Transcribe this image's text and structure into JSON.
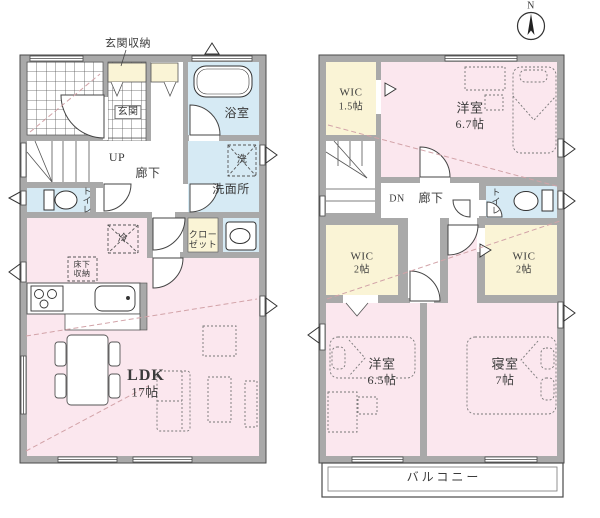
{
  "labels": {
    "genkan_storage": "玄関収納",
    "genkan": "玄関",
    "bathroom": "浴室",
    "up": "UP",
    "hallway": "廊下",
    "washer": "洗",
    "fridge": "冷",
    "washroom": "洗面所",
    "toilet": "トイレ",
    "closet": "クロー\nゼット",
    "underfloor_storage": "床下\n収納",
    "ldk": "LDK",
    "ldk_size": "17帖",
    "wic": "WIC",
    "wic_15_size": "1.5帖",
    "western_room": "洋室",
    "western_room_67_size": "6.7帖",
    "down": "DN",
    "wic_2_size": "2帖",
    "western_room_65_size": "6.5帖",
    "bedroom": "寝室",
    "bedroom_size": "7帖",
    "balcony": "バルコニー",
    "north": "N"
  },
  "colors": {
    "room_pink": "#fbe7ee",
    "room_yellow": "#faf4d6",
    "room_blue": "#d6eaf4",
    "wall_gray": "#a9a9a9",
    "diagonal_dash": "#d2a3a8"
  }
}
